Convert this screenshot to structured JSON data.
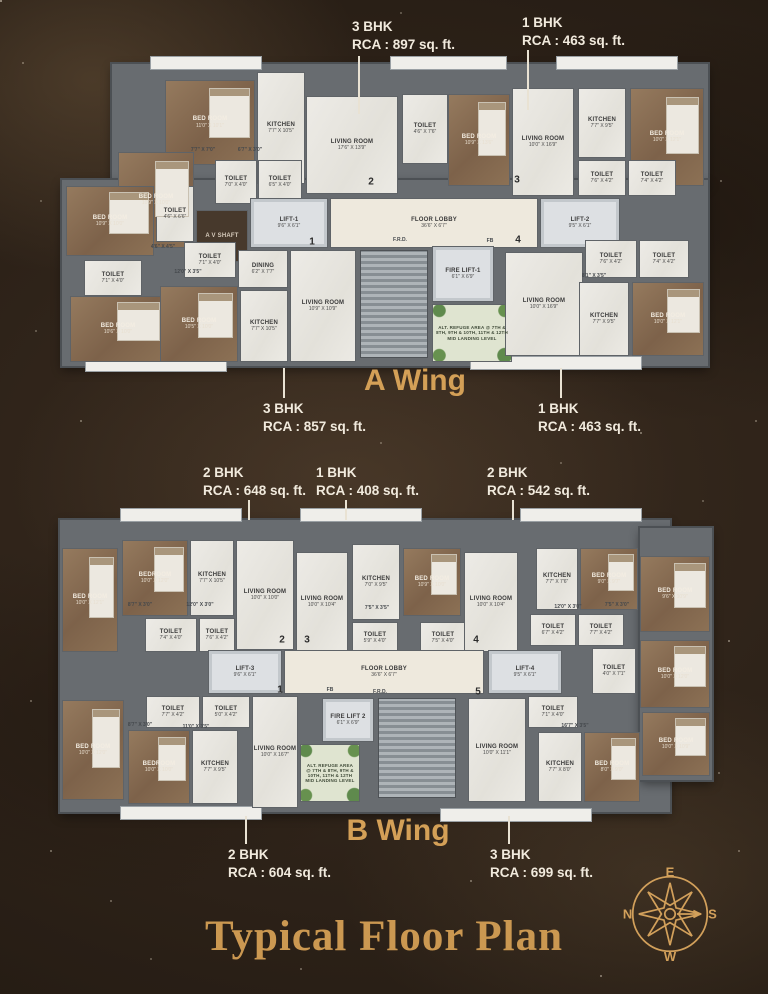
{
  "page": {
    "title": "Typical Floor Plan"
  },
  "compass": {
    "top": "E",
    "right": "S",
    "bottom": "W",
    "left": "N"
  },
  "wings": [
    {
      "id": "wing-a",
      "label": "A Wing",
      "label_pos": {
        "x": 415,
        "y": 364
      },
      "bases": [
        {
          "x": 112,
          "y": 64,
          "w": 596,
          "h": 120
        },
        {
          "x": 62,
          "y": 180,
          "w": 646,
          "h": 186
        }
      ],
      "decks": [
        {
          "x": 150,
          "y": 56,
          "w": 110,
          "h": 12
        },
        {
          "x": 390,
          "y": 56,
          "w": 115,
          "h": 12
        },
        {
          "x": 556,
          "y": 56,
          "w": 120,
          "h": 12
        },
        {
          "x": 85,
          "y": 358,
          "w": 140,
          "h": 12
        },
        {
          "x": 470,
          "y": 356,
          "w": 170,
          "h": 12
        }
      ],
      "rooms": [
        {
          "label": "BED ROOM",
          "dim": "11'0\" X 10'1\"",
          "x": 165,
          "y": 80,
          "w": 90,
          "h": 85,
          "t": "wood"
        },
        {
          "label": "KITCHEN",
          "dim": "7'7\" X 10'5\"",
          "x": 257,
          "y": 72,
          "w": 48,
          "h": 112,
          "t": "marble"
        },
        {
          "label": "BED ROOM",
          "dim": "10'9\" X 10'0\"",
          "x": 118,
          "y": 152,
          "w": 76,
          "h": 96,
          "t": "wood"
        },
        {
          "label": "TOILET",
          "dim": "7'0\" X 4'0\"",
          "x": 215,
          "y": 160,
          "w": 42,
          "h": 44,
          "t": "marble"
        },
        {
          "label": "TOILET",
          "dim": "6'5\" X 4'0\"",
          "x": 258,
          "y": 160,
          "w": 44,
          "h": 44,
          "t": "marble"
        },
        {
          "label": "LIVING ROOM",
          "dim": "17'6\" X 13'9\"",
          "x": 306,
          "y": 96,
          "w": 92,
          "h": 98,
          "t": "marble"
        },
        {
          "label": "TOILET",
          "dim": "4'6\" X 7'6\"",
          "x": 402,
          "y": 94,
          "w": 46,
          "h": 70,
          "t": "marble"
        },
        {
          "label": "BED ROOM",
          "dim": "10'9\" X 13'6\"",
          "x": 448,
          "y": 94,
          "w": 62,
          "h": 92,
          "t": "wood"
        },
        {
          "label": "LIVING ROOM",
          "dim": "10'0\" X 16'9\"",
          "x": 512,
          "y": 88,
          "w": 62,
          "h": 108,
          "t": "marble"
        },
        {
          "label": "KITCHEN",
          "dim": "7'7\" X 9'5\"",
          "x": 578,
          "y": 88,
          "w": 48,
          "h": 70,
          "t": "marble"
        },
        {
          "label": "BED ROOM",
          "dim": "10'0\" X 12'1\"",
          "x": 630,
          "y": 88,
          "w": 74,
          "h": 98,
          "t": "wood"
        },
        {
          "label": "TOILET",
          "dim": "7'6\" X 4'2\"",
          "x": 578,
          "y": 160,
          "w": 48,
          "h": 36,
          "t": "marble"
        },
        {
          "label": "TOILET",
          "dim": "7'4\" X 4'2\"",
          "x": 628,
          "y": 160,
          "w": 48,
          "h": 36,
          "t": "marble"
        },
        {
          "label": "A V SHAFT",
          "dim": "",
          "x": 196,
          "y": 210,
          "w": 52,
          "h": 52,
          "t": "shaft"
        },
        {
          "label": "LIFT-1",
          "dim": "9'6\" X 6'1\"",
          "x": 250,
          "y": 198,
          "w": 78,
          "h": 50,
          "t": "lift"
        },
        {
          "label": "FLOOR LOBBY",
          "dim": "36'6\" X 6'7\"",
          "x": 330,
          "y": 198,
          "w": 208,
          "h": 50,
          "t": "lobby"
        },
        {
          "label": "LIFT-2",
          "dim": "9'5\" X 6'1\"",
          "x": 540,
          "y": 198,
          "w": 80,
          "h": 50,
          "t": "lift"
        },
        {
          "label": "",
          "dim": "",
          "x": 360,
          "y": 250,
          "w": 68,
          "h": 108,
          "t": "stair"
        },
        {
          "label": "FIRE LIFT-1",
          "dim": "6'1\" X 6'9\"",
          "x": 432,
          "y": 246,
          "w": 62,
          "h": 56,
          "t": "lift"
        },
        {
          "label": "ALT. REFUGE AREA @ 7TH & 8TH, 9TH & 10TH, 11TH & 12TH MID LANDING LEVEL",
          "dim": "",
          "x": 432,
          "y": 304,
          "w": 80,
          "h": 58,
          "t": "refuge"
        },
        {
          "label": "BED ROOM",
          "dim": "10'9\" X 10'0\"",
          "x": 66,
          "y": 186,
          "w": 88,
          "h": 70,
          "t": "wood"
        },
        {
          "label": "TOILET",
          "dim": "4'6\" X 6'6\"",
          "x": 156,
          "y": 186,
          "w": 38,
          "h": 56,
          "t": "marble"
        },
        {
          "label": "TOILET",
          "dim": "7'1\" X 4'0\"",
          "x": 184,
          "y": 242,
          "w": 52,
          "h": 36,
          "t": "marble"
        },
        {
          "label": "TOILET",
          "dim": "7'1\" X 4'0\"",
          "x": 84,
          "y": 260,
          "w": 58,
          "h": 36,
          "t": "marble"
        },
        {
          "label": "BED ROOM",
          "dim": "10'6\" X 10'0\"",
          "x": 70,
          "y": 296,
          "w": 96,
          "h": 66,
          "t": "wood"
        },
        {
          "label": "BED ROOM",
          "dim": "10'5\" X 10'0\"",
          "x": 160,
          "y": 286,
          "w": 78,
          "h": 76,
          "t": "wood"
        },
        {
          "label": "DINING",
          "dim": "6'2\" X 7'7\"",
          "x": 238,
          "y": 250,
          "w": 50,
          "h": 38,
          "t": "marble"
        },
        {
          "label": "KITCHEN",
          "dim": "7'7\" X 10'5\"",
          "x": 240,
          "y": 290,
          "w": 48,
          "h": 72,
          "t": "marble"
        },
        {
          "label": "LIVING ROOM",
          "dim": "10'9\" X 10'9\"",
          "x": 290,
          "y": 250,
          "w": 66,
          "h": 112,
          "t": "marble"
        },
        {
          "label": "LIVING ROOM",
          "dim": "10'0\" X 16'9\"",
          "x": 505,
          "y": 252,
          "w": 78,
          "h": 104,
          "t": "marble"
        },
        {
          "label": "TOILET",
          "dim": "7'6\" X 4'2\"",
          "x": 585,
          "y": 240,
          "w": 52,
          "h": 38,
          "t": "marble"
        },
        {
          "label": "TOILET",
          "dim": "7'4\" X 4'2\"",
          "x": 639,
          "y": 240,
          "w": 50,
          "h": 38,
          "t": "marble"
        },
        {
          "label": "KITCHEN",
          "dim": "7'7\" X 9'5\"",
          "x": 579,
          "y": 282,
          "w": 50,
          "h": 74,
          "t": "marble"
        },
        {
          "label": "BED ROOM",
          "dim": "10'0\" X 12'1\"",
          "x": 632,
          "y": 282,
          "w": 72,
          "h": 74,
          "t": "wood"
        }
      ],
      "badges": [
        {
          "n": "2",
          "x": 371,
          "y": 182
        },
        {
          "n": "3",
          "x": 517,
          "y": 180
        },
        {
          "n": "1",
          "x": 312,
          "y": 242
        },
        {
          "n": "4",
          "x": 518,
          "y": 240
        }
      ],
      "dims": [
        {
          "t": "7'7\" X 7'0\"",
          "x": 203,
          "y": 150
        },
        {
          "t": "6'7\" X 3'0\"",
          "x": 250,
          "y": 150
        },
        {
          "t": "12'0\" X 3'5\"",
          "x": 188,
          "y": 272
        },
        {
          "t": "4'6\" X 4'5\"",
          "x": 163,
          "y": 247
        },
        {
          "t": "8'1\" X 3'5\"",
          "x": 594,
          "y": 276
        },
        {
          "t": "F.R.D.",
          "x": 400,
          "y": 240
        },
        {
          "t": "FB",
          "x": 490,
          "y": 241
        }
      ],
      "callouts": [
        {
          "unit": "3 BHK",
          "rca": "RCA : 897 sq. ft.",
          "x": 352,
          "y": 18,
          "leader": {
            "x": 358,
            "y1": 56,
            "y2": 114
          }
        },
        {
          "unit": "1 BHK",
          "rca": "RCA : 463 sq. ft.",
          "x": 522,
          "y": 14,
          "leader": {
            "x": 527,
            "y1": 50,
            "y2": 110
          }
        },
        {
          "unit": "3 BHK",
          "rca": "RCA : 857 sq. ft.",
          "x": 263,
          "y": 400,
          "leader": {
            "x": 283,
            "y1": 368,
            "y2": 398
          }
        },
        {
          "unit": "1 BHK",
          "rca": "RCA : 463 sq. ft.",
          "x": 538,
          "y": 400,
          "leader": {
            "x": 560,
            "y1": 368,
            "y2": 398
          }
        }
      ]
    },
    {
      "id": "wing-b",
      "label": "B Wing",
      "label_pos": {
        "x": 398,
        "y": 814
      },
      "bases": [
        {
          "x": 60,
          "y": 520,
          "w": 610,
          "h": 292
        },
        {
          "x": 640,
          "y": 528,
          "w": 72,
          "h": 252
        }
      ],
      "decks": [
        {
          "x": 120,
          "y": 508,
          "w": 120,
          "h": 12
        },
        {
          "x": 300,
          "y": 508,
          "w": 120,
          "h": 12
        },
        {
          "x": 520,
          "y": 508,
          "w": 120,
          "h": 12
        },
        {
          "x": 120,
          "y": 806,
          "w": 140,
          "h": 12
        },
        {
          "x": 440,
          "y": 808,
          "w": 150,
          "h": 12
        }
      ],
      "rooms": [
        {
          "label": "BED ROOM",
          "dim": "10'0\" X 12'1\"",
          "x": 62,
          "y": 548,
          "w": 56,
          "h": 104,
          "t": "wood"
        },
        {
          "label": "BEDROOM",
          "dim": "10'0\" X 12'0\"",
          "x": 122,
          "y": 540,
          "w": 66,
          "h": 76,
          "t": "wood"
        },
        {
          "label": "KITCHEN",
          "dim": "7'7\" X 10'5\"",
          "x": 190,
          "y": 540,
          "w": 44,
          "h": 76,
          "t": "marble"
        },
        {
          "label": "LIVING ROOM",
          "dim": "10'0\" X 10'0\"",
          "x": 236,
          "y": 540,
          "w": 58,
          "h": 110,
          "t": "marble"
        },
        {
          "label": "TOILET",
          "dim": "7'4\" X 4'0\"",
          "x": 145,
          "y": 618,
          "w": 52,
          "h": 34,
          "t": "marble"
        },
        {
          "label": "TOILET",
          "dim": "7'6\" X 4'2\"",
          "x": 199,
          "y": 618,
          "w": 36,
          "h": 34,
          "t": "marble"
        },
        {
          "label": "LIVING ROOM",
          "dim": "10'0\" X 10'4\"",
          "x": 296,
          "y": 552,
          "w": 52,
          "h": 100,
          "t": "marble"
        },
        {
          "label": "KITCHEN",
          "dim": "7'0\" X 9'5\"",
          "x": 352,
          "y": 544,
          "w": 48,
          "h": 76,
          "t": "marble"
        },
        {
          "label": "BED ROOM",
          "dim": "10'9\" X 10'0\"",
          "x": 403,
          "y": 548,
          "w": 58,
          "h": 68,
          "t": "wood"
        },
        {
          "label": "TOILET",
          "dim": "5'9\" X 4'0\"",
          "x": 352,
          "y": 622,
          "w": 46,
          "h": 32,
          "t": "marble"
        },
        {
          "label": "TOILET",
          "dim": "7'5\" X 4'0\"",
          "x": 420,
          "y": 622,
          "w": 46,
          "h": 32,
          "t": "marble"
        },
        {
          "label": "LIVING ROOM",
          "dim": "10'0\" X 10'4\"",
          "x": 464,
          "y": 552,
          "w": 54,
          "h": 100,
          "t": "marble"
        },
        {
          "label": "KITCHEN",
          "dim": "7'7\" X 7'6\"",
          "x": 536,
          "y": 548,
          "w": 42,
          "h": 62,
          "t": "marble"
        },
        {
          "label": "BED ROOM",
          "dim": "9'0\" X 9'7\"",
          "x": 580,
          "y": 548,
          "w": 58,
          "h": 62,
          "t": "wood"
        },
        {
          "label": "BED ROOM",
          "dim": "9'6\" X 10'9\"",
          "x": 640,
          "y": 556,
          "w": 70,
          "h": 76,
          "t": "wood"
        },
        {
          "label": "TOILET",
          "dim": "6'7\" X 4'2\"",
          "x": 530,
          "y": 614,
          "w": 46,
          "h": 32,
          "t": "marble"
        },
        {
          "label": "TOILET",
          "dim": "7'7\" X 4'2\"",
          "x": 578,
          "y": 614,
          "w": 46,
          "h": 32,
          "t": "marble"
        },
        {
          "label": "LIFT-3",
          "dim": "9'6\" X 6'1\"",
          "x": 208,
          "y": 650,
          "w": 74,
          "h": 44,
          "t": "lift"
        },
        {
          "label": "FLOOR LOBBY",
          "dim": "36'6\" X 6'7\"",
          "x": 284,
          "y": 650,
          "w": 200,
          "h": 44,
          "t": "lobby"
        },
        {
          "label": "LIFT-4",
          "dim": "9'5\" X 6'1\"",
          "x": 488,
          "y": 650,
          "w": 74,
          "h": 44,
          "t": "lift"
        },
        {
          "label": "TOILET",
          "dim": "4'0\" X 7'1\"",
          "x": 592,
          "y": 648,
          "w": 44,
          "h": 46,
          "t": "marble"
        },
        {
          "label": "BED ROOM",
          "dim": "10'0\" X 12'0\"",
          "x": 640,
          "y": 640,
          "w": 70,
          "h": 68,
          "t": "wood"
        },
        {
          "label": "FIRE LIFT 2",
          "dim": "6'1\" X 6'9\"",
          "x": 322,
          "y": 698,
          "w": 52,
          "h": 44,
          "t": "lift"
        },
        {
          "label": "",
          "dim": "",
          "x": 378,
          "y": 698,
          "w": 78,
          "h": 100,
          "t": "stair"
        },
        {
          "label": "ALT. REFUGE AREA @ 7TH & 8TH, 9TH & 10TH, 11TH & 12TH MID LANDING LEVEL",
          "dim": "",
          "x": 300,
          "y": 744,
          "w": 60,
          "h": 58,
          "t": "refuge"
        },
        {
          "label": "TOILET",
          "dim": "7'7\" X 4'2\"",
          "x": 146,
          "y": 696,
          "w": 54,
          "h": 32,
          "t": "marble"
        },
        {
          "label": "TOILET",
          "dim": "5'0\" X 4'2\"",
          "x": 202,
          "y": 696,
          "w": 48,
          "h": 32,
          "t": "marble"
        },
        {
          "label": "LIVING ROOM",
          "dim": "10'0\" X 16'7\"",
          "x": 252,
          "y": 696,
          "w": 46,
          "h": 112,
          "t": "marble"
        },
        {
          "label": "BED ROOM",
          "dim": "10'0\" X 12'0\"",
          "x": 62,
          "y": 700,
          "w": 62,
          "h": 100,
          "t": "wood"
        },
        {
          "label": "BEDROOM",
          "dim": "10'0\" X 10'0\"",
          "x": 128,
          "y": 730,
          "w": 62,
          "h": 74,
          "t": "wood"
        },
        {
          "label": "KITCHEN",
          "dim": "7'7\" X 9'5\"",
          "x": 192,
          "y": 730,
          "w": 46,
          "h": 74,
          "t": "marble"
        },
        {
          "label": "TOILET",
          "dim": "7'1\" X 4'0\"",
          "x": 528,
          "y": 696,
          "w": 50,
          "h": 32,
          "t": "marble"
        },
        {
          "label": "LIVING ROOM",
          "dim": "10'0\" X 11'1\"",
          "x": 468,
          "y": 698,
          "w": 58,
          "h": 104,
          "t": "marble"
        },
        {
          "label": "KITCHEN",
          "dim": "7'7\" X 8'0\"",
          "x": 538,
          "y": 732,
          "w": 44,
          "h": 70,
          "t": "marble"
        },
        {
          "label": "BED ROOM",
          "dim": "8'0\" X 9'0\"",
          "x": 584,
          "y": 732,
          "w": 56,
          "h": 70,
          "t": "wood"
        },
        {
          "label": "BED ROOM",
          "dim": "10'0\" X 10'9\"",
          "x": 642,
          "y": 712,
          "w": 68,
          "h": 64,
          "t": "wood"
        }
      ],
      "badges": [
        {
          "n": "2",
          "x": 282,
          "y": 640
        },
        {
          "n": "3",
          "x": 307,
          "y": 640
        },
        {
          "n": "4",
          "x": 476,
          "y": 640
        },
        {
          "n": "1",
          "x": 280,
          "y": 690
        },
        {
          "n": "5",
          "x": 478,
          "y": 692
        }
      ],
      "dims": [
        {
          "t": "8'7\" X 3'0\"",
          "x": 140,
          "y": 605
        },
        {
          "t": "12'0\" X 3'0\"",
          "x": 200,
          "y": 605
        },
        {
          "t": "7'5\" X 3'5\"",
          "x": 377,
          "y": 608
        },
        {
          "t": "12'0\" X 3'0\"",
          "x": 568,
          "y": 607
        },
        {
          "t": "7'5\" X 3'0\"",
          "x": 617,
          "y": 605
        },
        {
          "t": "8'7\" X 3'0\"",
          "x": 140,
          "y": 725
        },
        {
          "t": "11'0\" X 3'5\"",
          "x": 196,
          "y": 727
        },
        {
          "t": "16'7\" X 3'5\"",
          "x": 575,
          "y": 726
        },
        {
          "t": "F.R.D.",
          "x": 380,
          "y": 692
        },
        {
          "t": "FB",
          "x": 330,
          "y": 690
        }
      ],
      "callouts": [
        {
          "unit": "2 BHK",
          "rca": "RCA : 648 sq. ft.",
          "x": 203,
          "y": 464,
          "leader": {
            "x": 248,
            "y1": 500,
            "y2": 520
          }
        },
        {
          "unit": "1 BHK",
          "rca": "RCA : 408 sq. ft.",
          "x": 316,
          "y": 464,
          "leader": {
            "x": 345,
            "y1": 500,
            "y2": 520
          }
        },
        {
          "unit": "2 BHK",
          "rca": "RCA : 542 sq. ft.",
          "x": 487,
          "y": 464,
          "leader": {
            "x": 512,
            "y1": 500,
            "y2": 520
          }
        },
        {
          "unit": "2 BHK",
          "rca": "RCA : 604 sq. ft.",
          "x": 228,
          "y": 846,
          "leader": {
            "x": 245,
            "y1": 816,
            "y2": 844
          }
        },
        {
          "unit": "3 BHK",
          "rca": "RCA : 699 sq. ft.",
          "x": 490,
          "y": 846,
          "leader": {
            "x": 508,
            "y1": 816,
            "y2": 844
          }
        }
      ]
    }
  ]
}
